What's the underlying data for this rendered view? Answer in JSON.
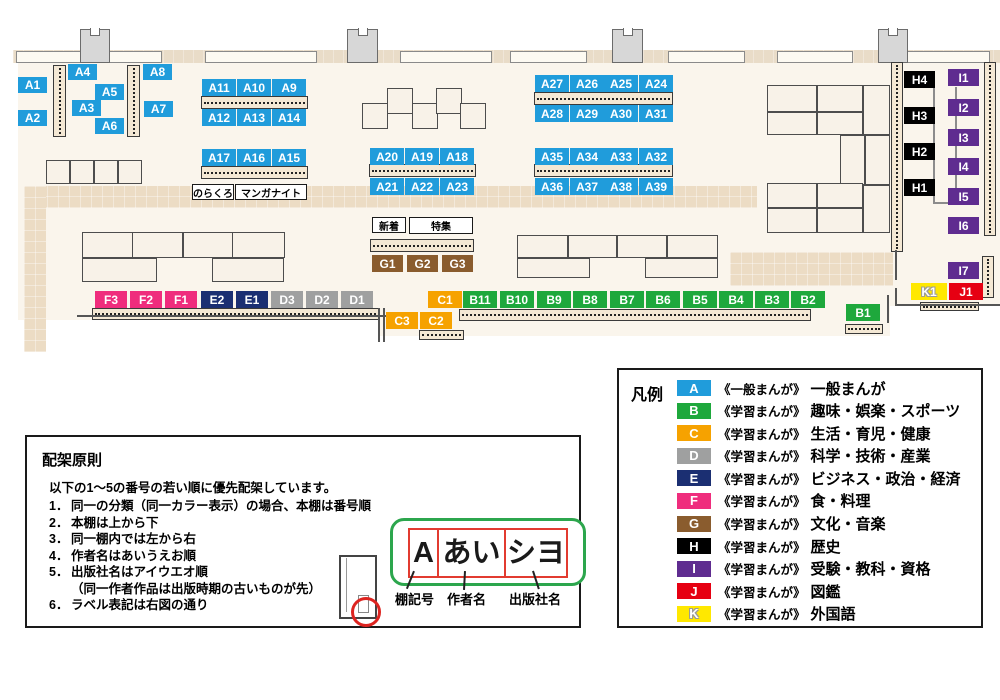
{
  "colors": {
    "A": "#209cdb",
    "B": "#1ea83c",
    "C": "#f6a200",
    "D": "#9fa0a0",
    "E": "#1b2f72",
    "F": "#ef2d7d",
    "G": "#8a5c2e",
    "H": "#000000",
    "I": "#5f2c90",
    "J": "#e60012",
    "K": "#ffe800"
  },
  "map": {
    "floors": [
      [
        18,
        63,
        982,
        243
      ],
      [
        18,
        306,
        872,
        14
      ],
      [
        380,
        320,
        510,
        16
      ]
    ],
    "walkways": [
      [
        25,
        186,
        732,
        22
      ],
      [
        24,
        186,
        22,
        166
      ],
      [
        730,
        252,
        163,
        34
      ]
    ],
    "wall_band": [
      13,
      50,
      987,
      13
    ],
    "windows": [
      [
        16,
        51,
        146,
        12
      ],
      [
        205,
        51,
        112,
        12
      ],
      [
        400,
        51,
        92,
        12
      ],
      [
        510,
        51,
        77,
        12
      ],
      [
        668,
        51,
        77,
        12
      ],
      [
        777,
        51,
        76,
        12
      ],
      [
        906,
        51,
        84,
        12
      ]
    ],
    "pillars": [
      [
        80,
        29,
        30,
        34
      ],
      [
        347,
        29,
        31,
        34
      ],
      [
        612,
        29,
        31,
        34
      ],
      [
        878,
        29,
        30,
        34
      ]
    ],
    "tables": [
      [
        362,
        103,
        26,
        26
      ],
      [
        387,
        88,
        26,
        26
      ],
      [
        412,
        103,
        26,
        26
      ],
      [
        436,
        88,
        26,
        26
      ],
      [
        460,
        103,
        26,
        26
      ],
      [
        46,
        160,
        24,
        24
      ],
      [
        70,
        160,
        24,
        24
      ],
      [
        94,
        160,
        24,
        24
      ],
      [
        118,
        160,
        24,
        24
      ],
      [
        82,
        232,
        51,
        26
      ],
      [
        132,
        232,
        51,
        26
      ],
      [
        183,
        232,
        50,
        26
      ],
      [
        232,
        232,
        53,
        26
      ],
      [
        82,
        258,
        75,
        24
      ],
      [
        212,
        258,
        72,
        24
      ],
      [
        517,
        235,
        51,
        23
      ],
      [
        568,
        235,
        49,
        23
      ],
      [
        617,
        235,
        50,
        23
      ],
      [
        667,
        235,
        51,
        23
      ],
      [
        517,
        258,
        73,
        20
      ],
      [
        645,
        258,
        73,
        20
      ],
      [
        767,
        85,
        50,
        27
      ],
      [
        817,
        85,
        46,
        27
      ],
      [
        863,
        85,
        27,
        50
      ],
      [
        767,
        112,
        50,
        23
      ],
      [
        817,
        112,
        46,
        23
      ],
      [
        840,
        135,
        25,
        50
      ],
      [
        865,
        135,
        25,
        50
      ],
      [
        767,
        183,
        50,
        25
      ],
      [
        817,
        183,
        46,
        25
      ],
      [
        863,
        185,
        27,
        48
      ],
      [
        767,
        208,
        50,
        25
      ],
      [
        817,
        208,
        46,
        25
      ]
    ],
    "shelves_h": [
      [
        201,
        96,
        107,
        13
      ],
      [
        201,
        166,
        107,
        13
      ],
      [
        369,
        164,
        107,
        13
      ],
      [
        534,
        92,
        139,
        13
      ],
      [
        534,
        164,
        139,
        13
      ],
      [
        370,
        239,
        104,
        13
      ],
      [
        92,
        308,
        287,
        12
      ],
      [
        459,
        309,
        352,
        12
      ],
      [
        419,
        330,
        45,
        10
      ],
      [
        845,
        324,
        38,
        10
      ],
      [
        920,
        302,
        59,
        9
      ]
    ],
    "shelves_v": [
      [
        53,
        65,
        13,
        72
      ],
      [
        127,
        65,
        13,
        72
      ],
      [
        891,
        62,
        12,
        190
      ],
      [
        984,
        62,
        12,
        174
      ],
      [
        982,
        256,
        12,
        42
      ]
    ],
    "wall_lines": [
      [
        77,
        315,
        311,
        2
      ],
      [
        378,
        308,
        2,
        34
      ],
      [
        383,
        308,
        2,
        34
      ],
      [
        897,
        304,
        103,
        2
      ],
      [
        895,
        250,
        2,
        30
      ],
      [
        895,
        288,
        2,
        18
      ],
      [
        887,
        295,
        2,
        28
      ]
    ],
    "connectors": [
      [
        933,
        88,
        2,
        116
      ],
      [
        955,
        87,
        2,
        117
      ],
      [
        933,
        202,
        24,
        2
      ]
    ],
    "labels": [
      {
        "id": "A1",
        "c": "A",
        "x": 18,
        "y": 77,
        "w": 29,
        "h": 16
      },
      {
        "id": "A2",
        "c": "A",
        "x": 18,
        "y": 110,
        "w": 29,
        "h": 16
      },
      {
        "id": "A3",
        "c": "A",
        "x": 72,
        "y": 100,
        "w": 29,
        "h": 16
      },
      {
        "id": "A4",
        "c": "A",
        "x": 68,
        "y": 64,
        "w": 29,
        "h": 16
      },
      {
        "id": "A5",
        "c": "A",
        "x": 95,
        "y": 84,
        "w": 29,
        "h": 16
      },
      {
        "id": "A6",
        "c": "A",
        "x": 95,
        "y": 118,
        "w": 29,
        "h": 16
      },
      {
        "id": "A7",
        "c": "A",
        "x": 144,
        "y": 101,
        "w": 29,
        "h": 16
      },
      {
        "id": "A8",
        "c": "A",
        "x": 143,
        "y": 64,
        "w": 29,
        "h": 16
      },
      {
        "id": "A11",
        "c": "A",
        "x": 202,
        "y": 79,
        "w": 34,
        "h": 17
      },
      {
        "id": "A10",
        "c": "A",
        "x": 237,
        "y": 79,
        "w": 34,
        "h": 17
      },
      {
        "id": "A9",
        "c": "A",
        "x": 272,
        "y": 79,
        "w": 34,
        "h": 17
      },
      {
        "id": "A12",
        "c": "A",
        "x": 202,
        "y": 109,
        "w": 34,
        "h": 17
      },
      {
        "id": "A13",
        "c": "A",
        "x": 237,
        "y": 109,
        "w": 34,
        "h": 17
      },
      {
        "id": "A14",
        "c": "A",
        "x": 272,
        "y": 109,
        "w": 34,
        "h": 17
      },
      {
        "id": "A17",
        "c": "A",
        "x": 202,
        "y": 149,
        "w": 34,
        "h": 17
      },
      {
        "id": "A16",
        "c": "A",
        "x": 237,
        "y": 149,
        "w": 34,
        "h": 17
      },
      {
        "id": "A15",
        "c": "A",
        "x": 272,
        "y": 149,
        "w": 34,
        "h": 17
      },
      {
        "id": "A20",
        "c": "A",
        "x": 370,
        "y": 148,
        "w": 34,
        "h": 17
      },
      {
        "id": "A19",
        "c": "A",
        "x": 405,
        "y": 148,
        "w": 34,
        "h": 17
      },
      {
        "id": "A18",
        "c": "A",
        "x": 440,
        "y": 148,
        "w": 34,
        "h": 17
      },
      {
        "id": "A21",
        "c": "A",
        "x": 370,
        "y": 178,
        "w": 34,
        "h": 17
      },
      {
        "id": "A22",
        "c": "A",
        "x": 405,
        "y": 178,
        "w": 34,
        "h": 17
      },
      {
        "id": "A23",
        "c": "A",
        "x": 440,
        "y": 178,
        "w": 34,
        "h": 17
      },
      {
        "id": "A27",
        "c": "A",
        "x": 535,
        "y": 75,
        "w": 34,
        "h": 17
      },
      {
        "id": "A26",
        "c": "A",
        "x": 570,
        "y": 75,
        "w": 34,
        "h": 17
      },
      {
        "id": "A25",
        "c": "A",
        "x": 604,
        "y": 75,
        "w": 34,
        "h": 17
      },
      {
        "id": "A24",
        "c": "A",
        "x": 639,
        "y": 75,
        "w": 34,
        "h": 17
      },
      {
        "id": "A28",
        "c": "A",
        "x": 535,
        "y": 105,
        "w": 34,
        "h": 17
      },
      {
        "id": "A29",
        "c": "A",
        "x": 570,
        "y": 105,
        "w": 34,
        "h": 17
      },
      {
        "id": "A30",
        "c": "A",
        "x": 604,
        "y": 105,
        "w": 34,
        "h": 17
      },
      {
        "id": "A31",
        "c": "A",
        "x": 639,
        "y": 105,
        "w": 34,
        "h": 17
      },
      {
        "id": "A35",
        "c": "A",
        "x": 535,
        "y": 148,
        "w": 34,
        "h": 17
      },
      {
        "id": "A34",
        "c": "A",
        "x": 570,
        "y": 148,
        "w": 34,
        "h": 17
      },
      {
        "id": "A33",
        "c": "A",
        "x": 604,
        "y": 148,
        "w": 34,
        "h": 17
      },
      {
        "id": "A32",
        "c": "A",
        "x": 639,
        "y": 148,
        "w": 34,
        "h": 17
      },
      {
        "id": "A36",
        "c": "A",
        "x": 535,
        "y": 178,
        "w": 34,
        "h": 17
      },
      {
        "id": "A37",
        "c": "A",
        "x": 570,
        "y": 178,
        "w": 34,
        "h": 17
      },
      {
        "id": "A38",
        "c": "A",
        "x": 604,
        "y": 178,
        "w": 34,
        "h": 17
      },
      {
        "id": "A39",
        "c": "A",
        "x": 639,
        "y": 178,
        "w": 34,
        "h": 17
      },
      {
        "id": "G1",
        "c": "G",
        "x": 372,
        "y": 255,
        "w": 31,
        "h": 17
      },
      {
        "id": "G2",
        "c": "G",
        "x": 407,
        "y": 255,
        "w": 31,
        "h": 17
      },
      {
        "id": "G3",
        "c": "G",
        "x": 442,
        "y": 255,
        "w": 31,
        "h": 17
      },
      {
        "id": "F3",
        "c": "F",
        "x": 95,
        "y": 291,
        "w": 32,
        "h": 17
      },
      {
        "id": "F2",
        "c": "F",
        "x": 130,
        "y": 291,
        "w": 32,
        "h": 17
      },
      {
        "id": "F1",
        "c": "F",
        "x": 165,
        "y": 291,
        "w": 32,
        "h": 17
      },
      {
        "id": "E2",
        "c": "E",
        "x": 201,
        "y": 291,
        "w": 32,
        "h": 17
      },
      {
        "id": "E1",
        "c": "E",
        "x": 236,
        "y": 291,
        "w": 32,
        "h": 17
      },
      {
        "id": "D3",
        "c": "D",
        "x": 271,
        "y": 291,
        "w": 32,
        "h": 17
      },
      {
        "id": "D2",
        "c": "D",
        "x": 306,
        "y": 291,
        "w": 32,
        "h": 17
      },
      {
        "id": "D1",
        "c": "D",
        "x": 341,
        "y": 291,
        "w": 32,
        "h": 17
      },
      {
        "id": "C1",
        "c": "C",
        "x": 428,
        "y": 291,
        "w": 34,
        "h": 17
      },
      {
        "id": "C3",
        "c": "C",
        "x": 386,
        "y": 312,
        "w": 32,
        "h": 17
      },
      {
        "id": "C2",
        "c": "C",
        "x": 420,
        "y": 312,
        "w": 32,
        "h": 17
      },
      {
        "id": "B11",
        "c": "B",
        "x": 463,
        "y": 291,
        "w": 34,
        "h": 17
      },
      {
        "id": "B10",
        "c": "B",
        "x": 500,
        "y": 291,
        "w": 34,
        "h": 17
      },
      {
        "id": "B9",
        "c": "B",
        "x": 537,
        "y": 291,
        "w": 34,
        "h": 17
      },
      {
        "id": "B8",
        "c": "B",
        "x": 573,
        "y": 291,
        "w": 34,
        "h": 17
      },
      {
        "id": "B7",
        "c": "B",
        "x": 610,
        "y": 291,
        "w": 34,
        "h": 17
      },
      {
        "id": "B6",
        "c": "B",
        "x": 646,
        "y": 291,
        "w": 34,
        "h": 17
      },
      {
        "id": "B5",
        "c": "B",
        "x": 683,
        "y": 291,
        "w": 34,
        "h": 17
      },
      {
        "id": "B4",
        "c": "B",
        "x": 719,
        "y": 291,
        "w": 34,
        "h": 17
      },
      {
        "id": "B3",
        "c": "B",
        "x": 755,
        "y": 291,
        "w": 34,
        "h": 17
      },
      {
        "id": "B2",
        "c": "B",
        "x": 791,
        "y": 291,
        "w": 34,
        "h": 17
      },
      {
        "id": "B1",
        "c": "B",
        "x": 846,
        "y": 304,
        "w": 34,
        "h": 17
      },
      {
        "id": "H4",
        "c": "H",
        "x": 904,
        "y": 71,
        "w": 31,
        "h": 17
      },
      {
        "id": "H3",
        "c": "H",
        "x": 904,
        "y": 107,
        "w": 31,
        "h": 17
      },
      {
        "id": "H2",
        "c": "H",
        "x": 904,
        "y": 143,
        "w": 31,
        "h": 17
      },
      {
        "id": "H1",
        "c": "H",
        "x": 904,
        "y": 179,
        "w": 31,
        "h": 17
      },
      {
        "id": "I1",
        "c": "I",
        "x": 948,
        "y": 69,
        "w": 31,
        "h": 17
      },
      {
        "id": "I2",
        "c": "I",
        "x": 948,
        "y": 99,
        "w": 31,
        "h": 17
      },
      {
        "id": "I3",
        "c": "I",
        "x": 948,
        "y": 129,
        "w": 31,
        "h": 17
      },
      {
        "id": "I4",
        "c": "I",
        "x": 948,
        "y": 158,
        "w": 31,
        "h": 17
      },
      {
        "id": "I5",
        "c": "I",
        "x": 948,
        "y": 188,
        "w": 31,
        "h": 17
      },
      {
        "id": "I6",
        "c": "I",
        "x": 948,
        "y": 217,
        "w": 31,
        "h": 17
      },
      {
        "id": "I7",
        "c": "I",
        "x": 948,
        "y": 262,
        "w": 31,
        "h": 17
      },
      {
        "id": "K1",
        "c": "K",
        "x": 911,
        "y": 283,
        "w": 36,
        "h": 17
      },
      {
        "id": "J1",
        "c": "J",
        "x": 949,
        "y": 283,
        "w": 34,
        "h": 17
      }
    ],
    "tags": [
      {
        "text": "のらくろ",
        "x": 192,
        "y": 184,
        "w": 42,
        "h": 16
      },
      {
        "text": "マンガナイト",
        "x": 235,
        "y": 184,
        "w": 72,
        "h": 16
      },
      {
        "text": "新着",
        "x": 372,
        "y": 217,
        "w": 34,
        "h": 16
      },
      {
        "text": "特集",
        "x": 409,
        "y": 217,
        "w": 64,
        "h": 17
      }
    ]
  },
  "legend": {
    "title": "凡例",
    "items": [
      {
        "key": "A",
        "type": "《一般まんが》",
        "category": "一般まんが"
      },
      {
        "key": "B",
        "type": "《学習まんが》",
        "category": "趣味・娯楽・スポーツ"
      },
      {
        "key": "C",
        "type": "《学習まんが》",
        "category": "生活・育児・健康"
      },
      {
        "key": "D",
        "type": "《学習まんが》",
        "category": "科学・技術・産業"
      },
      {
        "key": "E",
        "type": "《学習まんが》",
        "category": "ビジネス・政治・経済"
      },
      {
        "key": "F",
        "type": "《学習まんが》",
        "category": "食・料理"
      },
      {
        "key": "G",
        "type": "《学習まんが》",
        "category": "文化・音楽"
      },
      {
        "key": "H",
        "type": "《学習まんが》",
        "category": "歴史"
      },
      {
        "key": "I",
        "type": "《学習まんが》",
        "category": "受験・教科・資格"
      },
      {
        "key": "J",
        "type": "《学習まんが》",
        "category": "図鑑"
      },
      {
        "key": "K",
        "type": "《学習まんが》",
        "category": "外国語"
      }
    ]
  },
  "principles": {
    "title": "配架原則",
    "intro": "以下の1～5の番号の若い順に優先配架しています。",
    "items": [
      {
        "n": "1．",
        "t": "同一の分類（同一カラー表示）の場合、本棚は番号順"
      },
      {
        "n": "2．",
        "t": "本棚は上から下"
      },
      {
        "n": "3．",
        "t": "同一棚内では左から右"
      },
      {
        "n": "4．",
        "t": "作者名はあいうえお順"
      },
      {
        "n": "5．",
        "t": "出版社名はアイウエオ順"
      },
      {
        "n": "",
        "t": "（同一作者作品は出版時期の古いものが先）",
        "indent": true
      },
      {
        "n": "6．",
        "t": "ラベル表記は右図の通り"
      }
    ],
    "label_example": {
      "shelf_code": "A",
      "author": "あい",
      "publisher": "シヨ"
    },
    "callouts": [
      "棚記号",
      "作者名",
      "出版社名"
    ]
  }
}
